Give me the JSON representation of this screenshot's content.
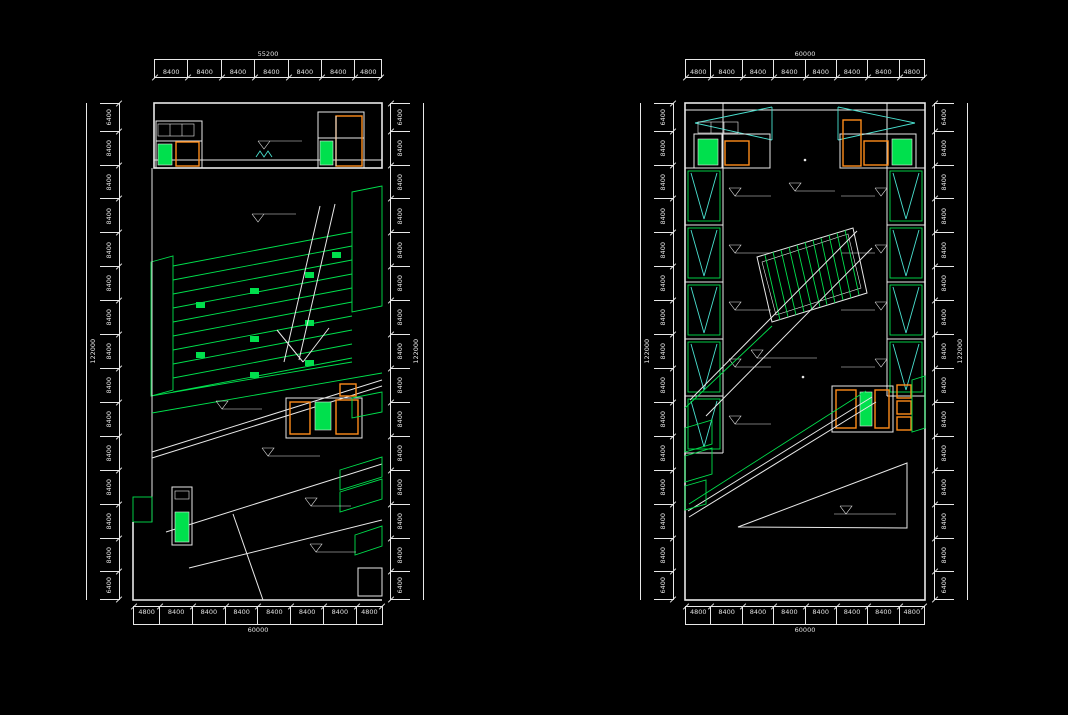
{
  "colors": {
    "background": "#000000",
    "line": "#e8e8e8",
    "green": "#00e04d",
    "cyan": "#49e0cf",
    "orange": "#ff8c1a",
    "dim_text": "#e0e0e0"
  },
  "left_plan": {
    "dim_top": {
      "total": "55200",
      "segments": [
        "8400",
        "8400",
        "8400",
        "8400",
        "8400",
        "8400",
        "4800"
      ]
    },
    "dim_bottom": {
      "total": "60000",
      "segments": [
        "4800",
        "8400",
        "8400",
        "8400",
        "8400",
        "8400",
        "8400",
        "4800"
      ]
    },
    "dim_left": {
      "total": "122000",
      "segments": [
        "6400",
        "8400",
        "8400",
        "8400",
        "8400",
        "8400",
        "8400",
        "8400",
        "8400",
        "8400",
        "8400",
        "8400",
        "8400",
        "8400",
        "6400"
      ]
    },
    "dim_right": {
      "total": "122000",
      "segments": [
        "6400",
        "8400",
        "8400",
        "8400",
        "8400",
        "8400",
        "8400",
        "8400",
        "8400",
        "8400",
        "8400",
        "8400",
        "8400",
        "8400",
        "6400"
      ]
    }
  },
  "right_plan": {
    "dim_top": {
      "total": "60000",
      "segments": [
        "4800",
        "8400",
        "8400",
        "8400",
        "8400",
        "8400",
        "8400",
        "4800"
      ]
    },
    "dim_bottom": {
      "total": "60000",
      "segments": [
        "4800",
        "8400",
        "8400",
        "8400",
        "8400",
        "8400",
        "8400",
        "4800"
      ]
    },
    "dim_left": {
      "total": "122000",
      "segments": [
        "6400",
        "8400",
        "8400",
        "8400",
        "8400",
        "8400",
        "8400",
        "8400",
        "8400",
        "8400",
        "8400",
        "8400",
        "8400",
        "8400",
        "6400"
      ]
    },
    "dim_right": {
      "total": "122000",
      "segments": [
        "6400",
        "8400",
        "8400",
        "8400",
        "8400",
        "8400",
        "8400",
        "8400",
        "8400",
        "8400",
        "8400",
        "8400",
        "8400",
        "8400",
        "6400"
      ]
    }
  }
}
